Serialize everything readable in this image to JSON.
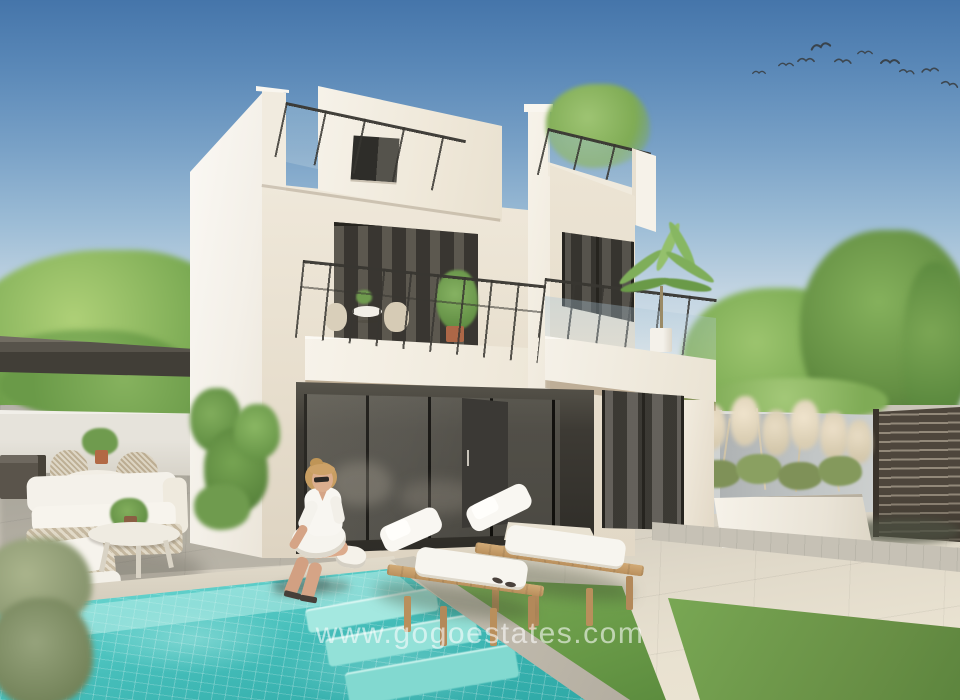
{
  "image": {
    "kind": "architectural-render-photo",
    "subject": "Modern white two-storey new-build villa with roof terrace, balconies, private mosaic swimming pool, sun loungers, lawn and walled patio garden under a clear blue sky",
    "width_px": 960,
    "height_px": 700
  },
  "watermark": {
    "text": "www.gogoestates.com",
    "color_hex": "#ffffff",
    "opacity": 0.58
  },
  "sky": {
    "top_hex": "#4575aa",
    "horizon_hex": "#e7ecee",
    "birds_in_flock": 10
  },
  "villa": {
    "storeys": 2,
    "wall_sunlit_hex": "#f6f3ec",
    "wall_cream_hex": "#ece4d6",
    "glazing_hex": "#33312d",
    "railing_hex": "#3a3833",
    "features": [
      "roof terrace with glass balustrade and bamboo planting",
      "small dark-framed window on penthouse level",
      "first-floor balcony with bistro table, two chairs and potted plant",
      "second balcony with palm plant in white pot",
      "recessed porch with dark glazed sliding doors and solid entrance door",
      "dark glazed sliding door with grey curtains on right wing"
    ]
  },
  "garden": {
    "pergola_hex": "#55514a",
    "lawn_hex": "#6b9c49",
    "pool_water_hex": "#45bdb9",
    "pool_tile_line_hex": "#cdf2ee",
    "coping_hex": "#ded7c7",
    "paving_sunlit_hex": "#e0d9c9",
    "paving_shaded_hex": "#b6b2aa",
    "fence_hex": "#4e463c",
    "boundary_wall_grey_hex": "#b9bdbe",
    "planter_hex": "#f1ede4",
    "pampas_hex": "#d9cdb2",
    "vine_green_hex": "#6f9b4e"
  },
  "people": [
    {
      "description": "Woman with blonde hair, sunglasses and white shirt dress sitting on the pool edge with feet over the water"
    }
  ],
  "furniture": [
    "dark storage bench against left wall",
    "round outdoor dining table with rope-weave chairs",
    "off-white lounge sofa and armchair with woven bases",
    "oval coffee table with potted plant",
    "two wooden sun loungers with white cushions on artificial lawn",
    "long white planter with pampas grass",
    "horizontal slatted dark privacy fence"
  ]
}
